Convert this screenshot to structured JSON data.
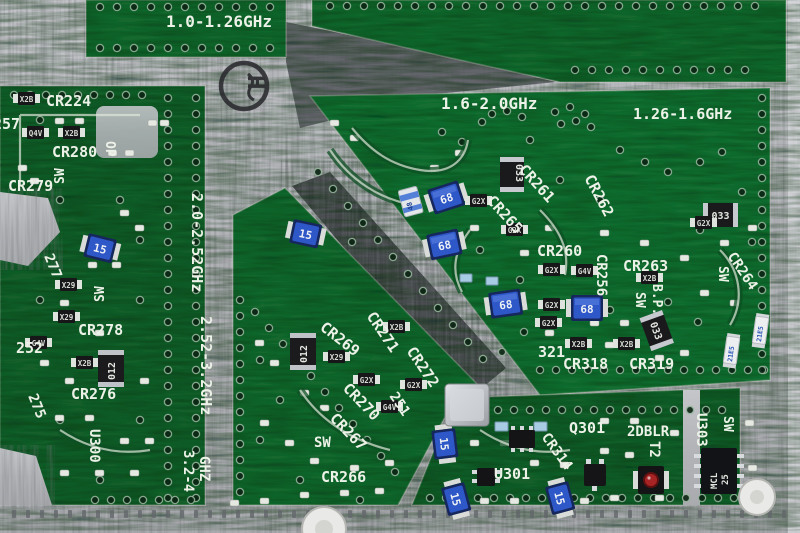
{
  "pcb": {
    "frequency_bands": {
      "b1": "1.0-1.26GHz",
      "b2": "1.6-2.0GHz",
      "b3": "1.26-1.6GHz",
      "b4": "2.0-2.52GHz",
      "b5": "2.52-3.2GHz",
      "b6a": "3.2-4",
      "b6b": "GHZ",
      "doubler": "2DBLR"
    },
    "refs": {
      "cr224": "CR224",
      "r257": "257",
      "cr280": "CR280",
      "op": "OP",
      "sw": "SW",
      "cr279": "CR279",
      "r277": "277",
      "cr278": "CR278",
      "r252": "252",
      "cr276": "CR276",
      "r275": "275",
      "u300": "U300",
      "cr269": "CR269",
      "cr271": "CR271",
      "cr272": "CR272",
      "cr270": "CR270",
      "r251": "251",
      "cr267": "CR267",
      "cr266": "CR266",
      "cr265": "CR265",
      "cr261": "CR261",
      "cr262": "CR262",
      "cr260": "CR260",
      "cr263": "CR263",
      "cr256": "CR256",
      "cr264": "CR264",
      "bp": "B.P.",
      "r321": "321",
      "cr318": "CR318",
      "cr319": "CR319",
      "q301": "Q301",
      "t2": "T2",
      "u303": "U303",
      "u301": "U301",
      "cr314": "CR314"
    },
    "marks": {
      "cap68": "68",
      "cap15": "15",
      "cap48": "48",
      "cap21e5": "21E5",
      "x2b": "X2B",
      "q4v": "Q4V",
      "x29": "X29",
      "g4v": "G4V",
      "g2x": "G2X",
      "r012": "012",
      "r033": "033",
      "mcl1": "MCL",
      "mcl2": "25"
    },
    "stamp_glyph": "H",
    "colors": {
      "board_green": "#17672f",
      "metal_silver": "#b4b6ba",
      "cap_blue": "#2e57c7",
      "silkscreen": "#edf2e8"
    }
  }
}
